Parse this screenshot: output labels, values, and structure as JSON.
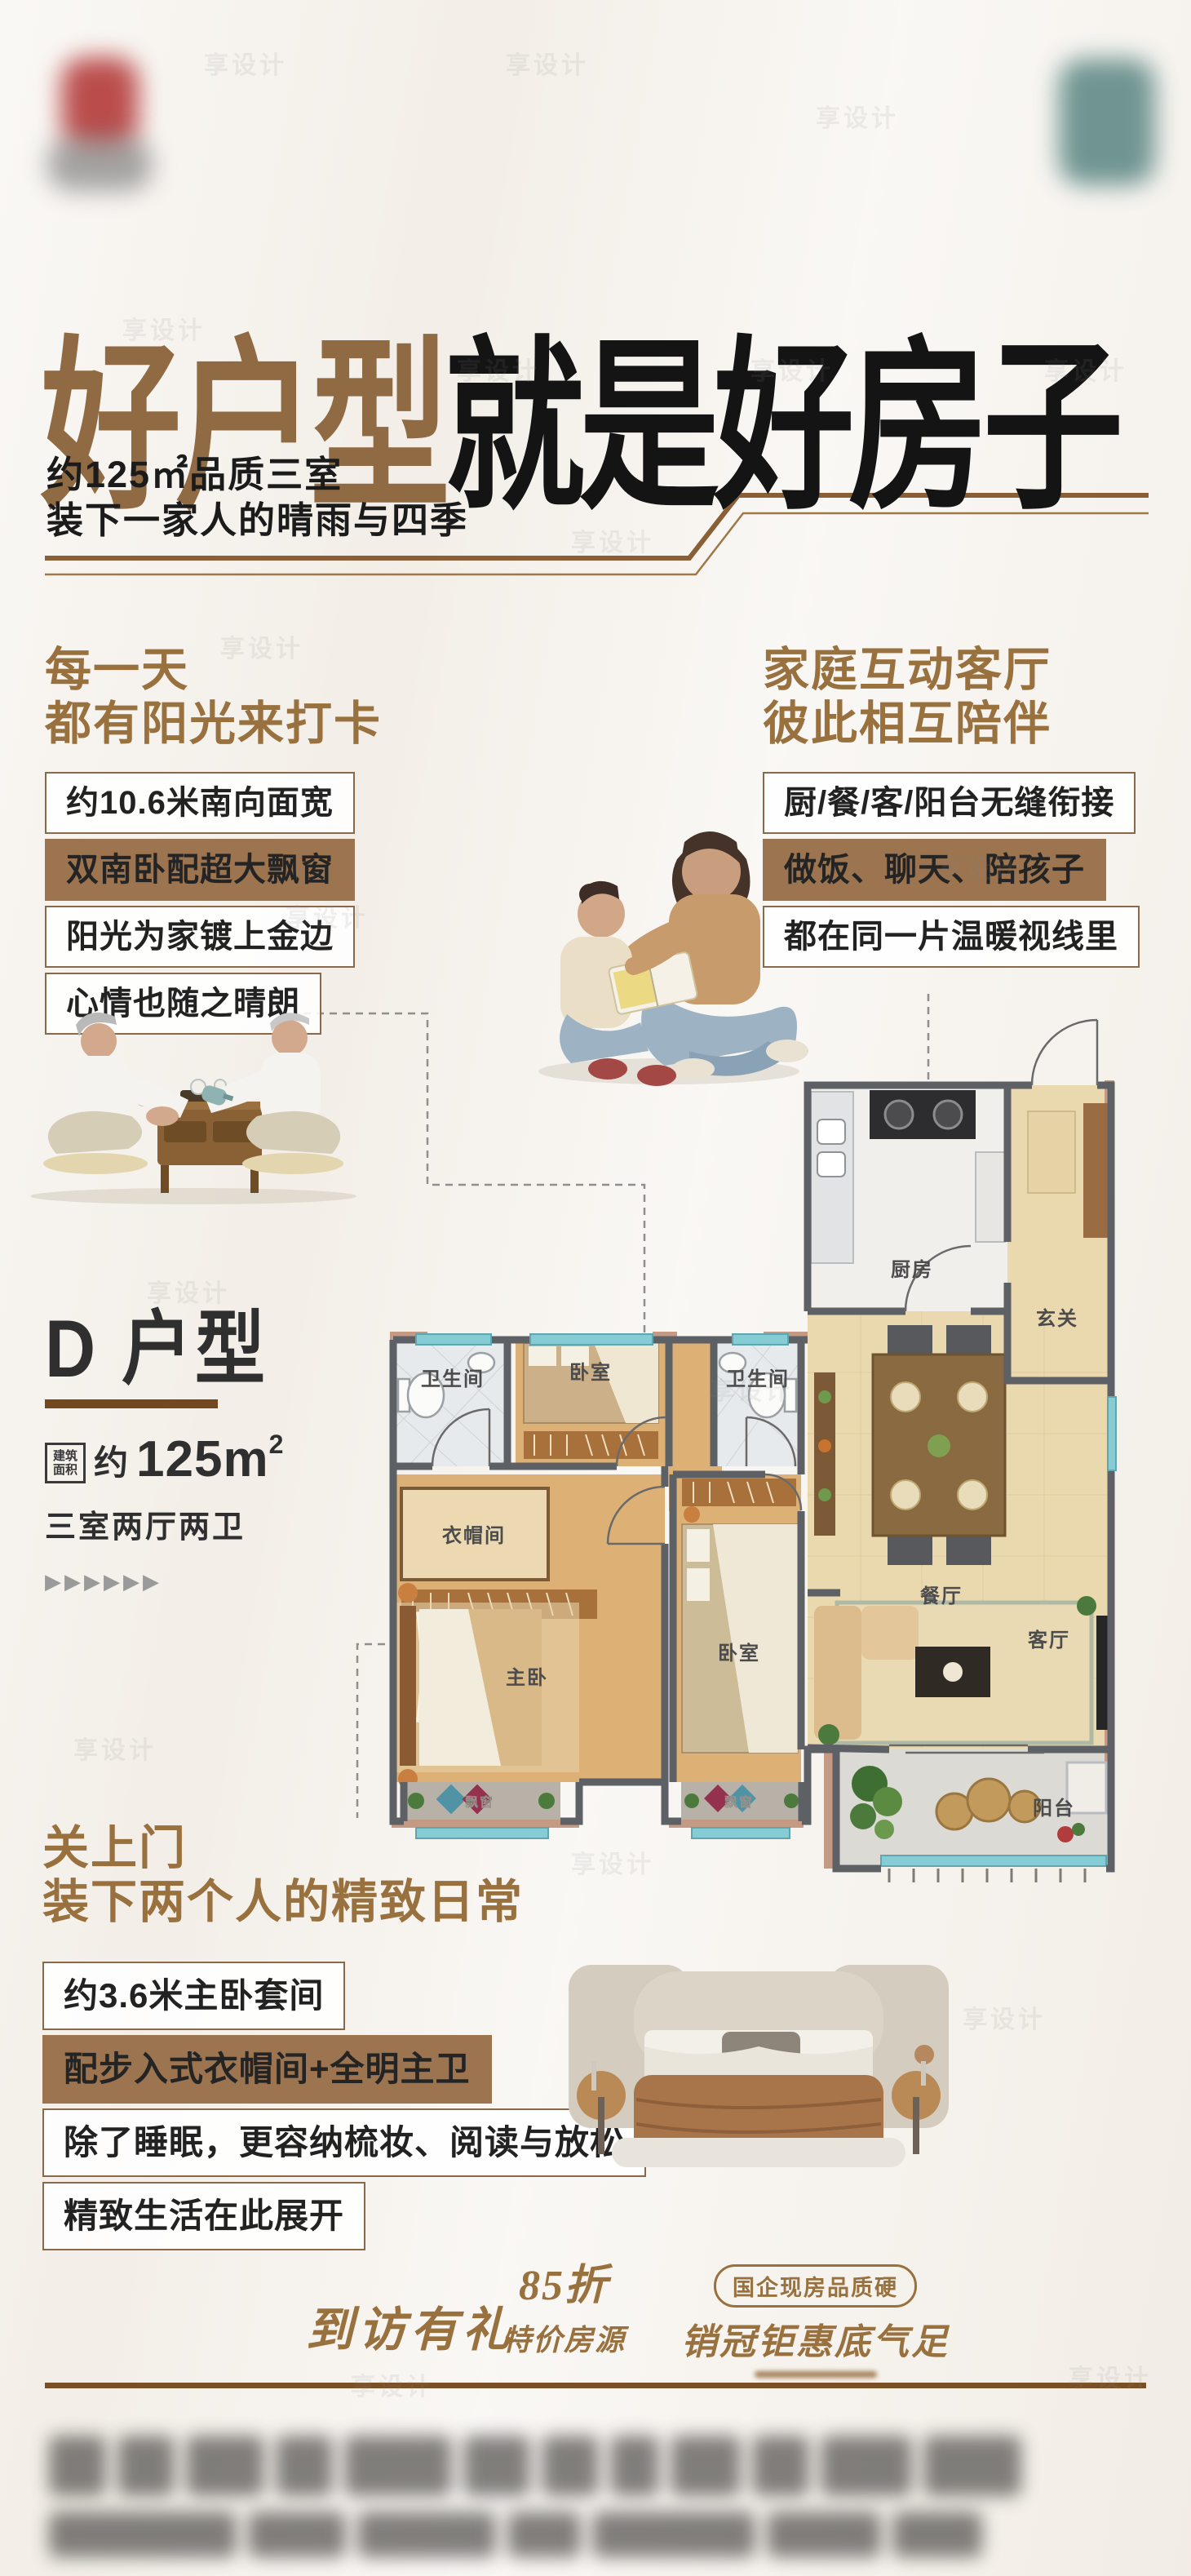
{
  "watermark": "享设计",
  "header": {
    "title_accent": "好户型",
    "title_main": "就是好房子",
    "sub1": "约125㎡品质三室",
    "sub2": "装下一家人的晴雨与四季"
  },
  "sun": {
    "h1": "每一天",
    "h2": "都有阳光来打卡",
    "items": [
      "约10.6米南向面宽",
      "双南卧配超大飘窗",
      "阳光为家镀上金边",
      "心情也随之晴朗"
    ]
  },
  "fam": {
    "h1": "家庭互动客厅",
    "h2": "彼此相互陪伴",
    "items": [
      "厨/餐/客/阳台无缝衔接",
      "做饭、聊天、陪孩子",
      "都在同一片温暖视线里"
    ]
  },
  "unit": {
    "name": "D 户型",
    "area_badge_l1": "建筑",
    "area_badge_l2": "面积",
    "area_prefix": "约",
    "area_value": "125m",
    "area_sup": "2",
    "layout": "三室两厅两卫",
    "arrows": "▶▶▶▶▶▶"
  },
  "plan": {
    "kitchen": "厨房",
    "entry": "玄关",
    "bath_a": "卫生间",
    "bed_top": "卧室",
    "bath_b": "卫生间",
    "dining": "餐厅",
    "cloak": "衣帽间",
    "master": "主卧",
    "bed_second": "卧室",
    "living": "客厅",
    "balcony": "阳台",
    "bay_a": "飘窗",
    "bay_b": "飘窗"
  },
  "master_sec": {
    "h1": "关上门",
    "h2": "装下两个人的精致日常",
    "items": [
      "约3.6米主卧套间",
      "配步入式衣帽间+全明主卫",
      "除了睡眠，更容纳梳妆、阅读与放松",
      "精致生活在此展开"
    ]
  },
  "badges": {
    "b1": "到访有礼",
    "b2_line1": "85折",
    "b2_line2": "特价房源",
    "b3_pill": "国企现房品质硬",
    "b3_main": "销冠钜惠底气足"
  },
  "colors": {
    "accent": "#99713f",
    "accent_deep": "#7a5026",
    "highlight_box": "#9c7450",
    "ink": "#141414"
  }
}
